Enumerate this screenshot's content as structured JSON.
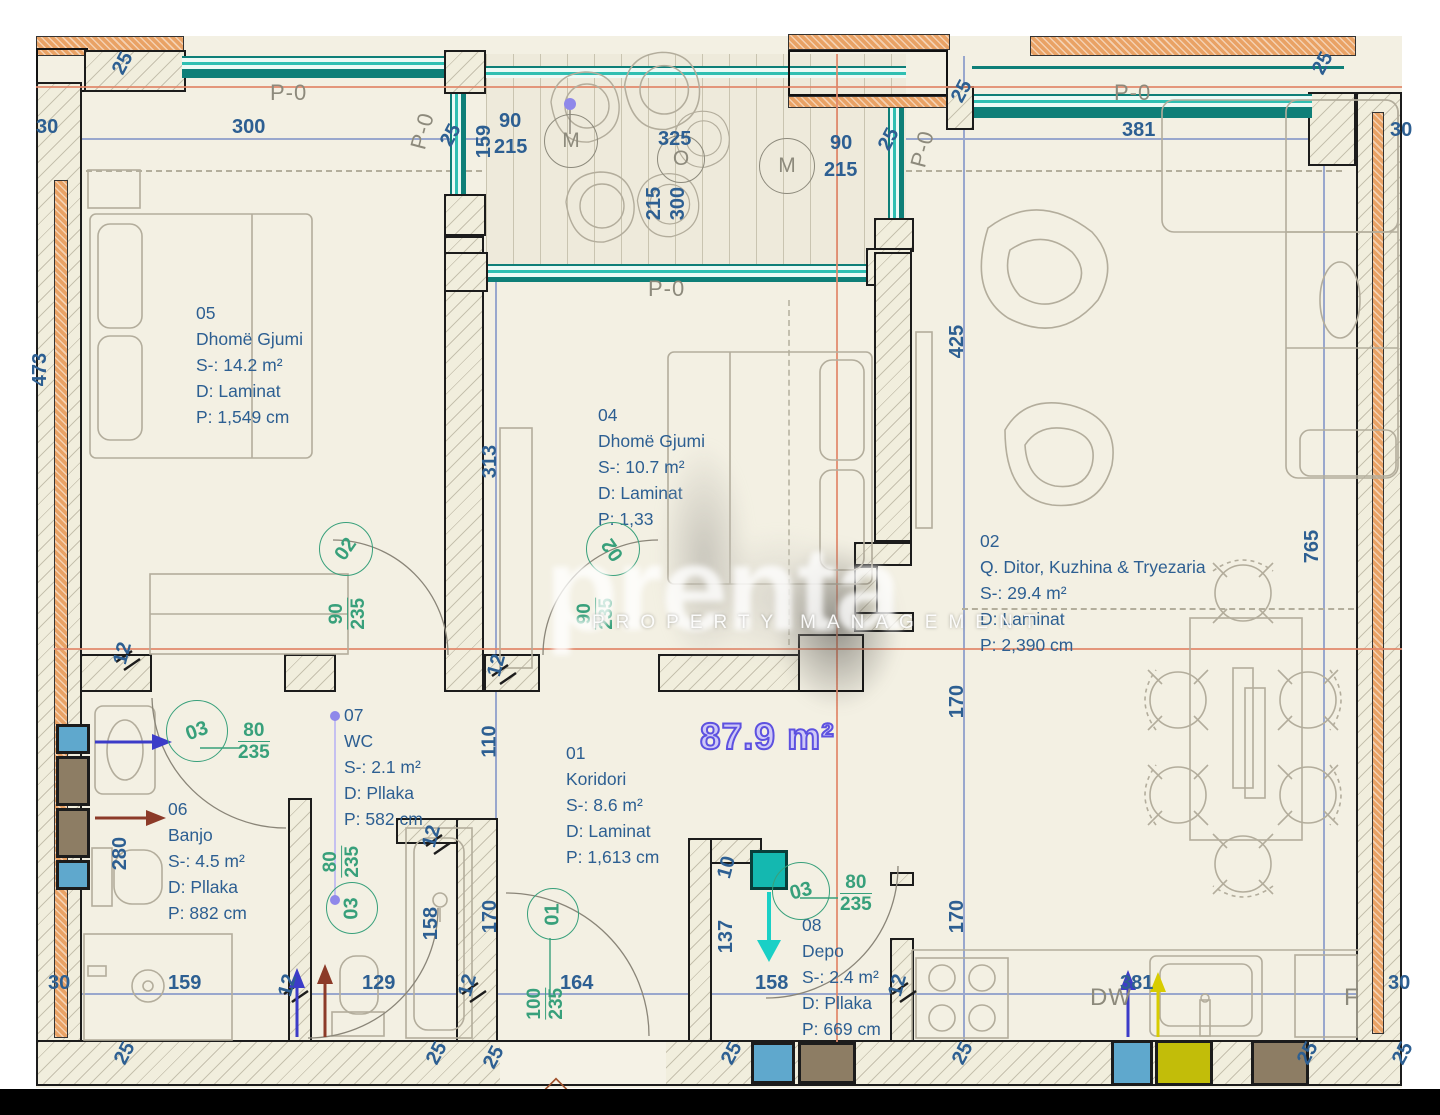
{
  "plan": {
    "total_area": "87.9 m²"
  },
  "watermark": {
    "big": "prenta",
    "sub": "PROPERTY MANAGEMENT"
  },
  "rooms": {
    "r05": {
      "id": "05",
      "name": "Dhomë Gjumi",
      "s": "S-: 14.2 m²",
      "d": "D: Laminat",
      "p": "P: 1,549 cm"
    },
    "r04": {
      "id": "04",
      "name": "Dhomë Gjumi",
      "s": "S-: 10.7 m²",
      "d": "D: Laminat",
      "p": "P: 1,33"
    },
    "r02": {
      "id": "02",
      "name": "Q. Ditor, Kuzhina & Tryezaria",
      "s": "S-: 29.4 m²",
      "d": "D: Laminat",
      "p": "P: 2,390 cm"
    },
    "r07": {
      "id": "07",
      "name": "WC",
      "s": "S-: 2.1 m²",
      "d": "D: Pllaka",
      "p": "P: 582 cm"
    },
    "r06": {
      "id": "06",
      "name": "Banjo",
      "s": "S-: 4.5 m²",
      "d": "D: Pllaka",
      "p": "P: 882 cm"
    },
    "r01": {
      "id": "01",
      "name": "Koridori",
      "s": "S-: 8.6 m²",
      "d": "D: Laminat",
      "p": "P: 1,613 cm"
    },
    "r08": {
      "id": "08",
      "name": "Depo",
      "s": "S-: 2.4 m²",
      "d": "D: Pllaka",
      "p": "P: 669 cm"
    }
  },
  "doors": {
    "d05": {
      "no": "02",
      "w": "90",
      "h": "235"
    },
    "d04": {
      "no": "02",
      "w": "90",
      "h": "235"
    },
    "bath": {
      "no": "03",
      "w": "80",
      "h": "235"
    },
    "wc": {
      "no": "03",
      "w": "80",
      "h": "235"
    },
    "depo": {
      "no": "03",
      "w": "80",
      "h": "235"
    },
    "entry": {
      "no": "01",
      "w": "100",
      "h": "235"
    }
  },
  "labels": {
    "p0": "P-0",
    "m": "M",
    "o": "O",
    "dw": "DW",
    "f": "F"
  },
  "dims": {
    "n25a": "25",
    "n30a": "30",
    "n300a": "300",
    "n25b": "25",
    "n159a": "159",
    "n90a": "90",
    "n215a": "215",
    "n325": "325",
    "n215b": "215",
    "n300b": "300",
    "n90b": "90",
    "n215c": "215",
    "n25c": "25",
    "n25d": "25",
    "n381a": "381",
    "n30b": "30",
    "n25e": "25",
    "n473": "473",
    "n313": "313",
    "n425": "425",
    "n765": "765",
    "n12a": "12",
    "n12b": "12",
    "n280": "280",
    "n110": "110",
    "n170a": "170",
    "n170b": "170",
    "n170c": "170",
    "n10": "10",
    "n137": "137",
    "n12c": "12",
    "n158a": "158",
    "n158b": "158",
    "n164": "164",
    "n30c": "30",
    "n159b": "159",
    "n12d": "12",
    "n129": "129",
    "n12e": "12",
    "n12f": "12",
    "n381b": "381",
    "n30d": "30",
    "n25f": "25",
    "n25g": "25",
    "n25h": "25",
    "n25i": "25",
    "n25j": "25",
    "n25k": "25",
    "n25l": "25"
  }
}
